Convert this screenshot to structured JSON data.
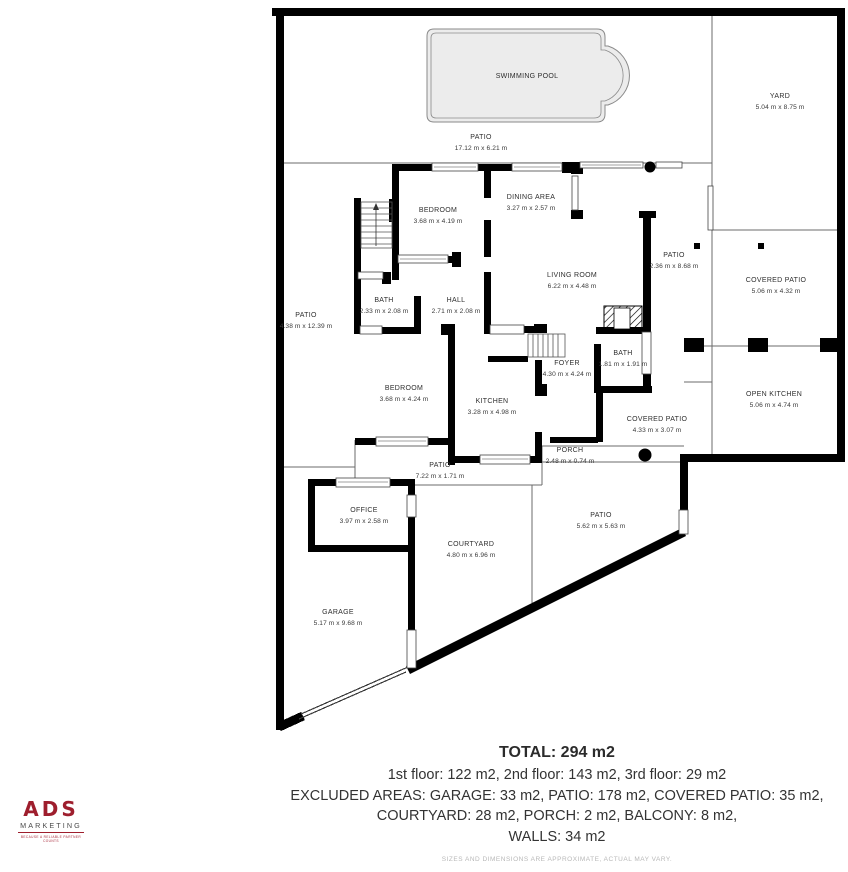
{
  "plan": {
    "rooms": [
      {
        "id": "swimming-pool",
        "name": "SWIMMING POOL",
        "dims": "",
        "x": 527,
        "y": 77
      },
      {
        "id": "yard",
        "name": "YARD",
        "dims": "5.04 m x 8.75 m",
        "x": 780,
        "y": 102
      },
      {
        "id": "patio-top",
        "name": "PATIO",
        "dims": "17.12 m x 6.21 m",
        "x": 481,
        "y": 143
      },
      {
        "id": "bedroom-1",
        "name": "BEDROOM",
        "dims": "3.68 m x 4.19 m",
        "x": 438,
        "y": 216
      },
      {
        "id": "dining-area",
        "name": "DINING AREA",
        "dims": "3.27 m x 2.57 m",
        "x": 531,
        "y": 203
      },
      {
        "id": "living-room",
        "name": "LIVING ROOM",
        "dims": "6.22 m x 4.48 m",
        "x": 572,
        "y": 281
      },
      {
        "id": "patio-right",
        "name": "PATIO",
        "dims": "2.36 m x 8.68 m",
        "x": 674,
        "y": 261
      },
      {
        "id": "covered-patio-right",
        "name": "COVERED PATIO",
        "dims": "5.06 m x 4.32 m",
        "x": 776,
        "y": 286
      },
      {
        "id": "bath-1",
        "name": "BATH",
        "dims": "2.33 m x 2.08 m",
        "x": 384,
        "y": 306
      },
      {
        "id": "hall",
        "name": "HALL",
        "dims": "2.71 m x 2.08 m",
        "x": 456,
        "y": 306
      },
      {
        "id": "patio-left",
        "name": "PATIO",
        "dims": "4.38 m x 12.39 m",
        "x": 306,
        "y": 321
      },
      {
        "id": "foyer",
        "name": "FOYER",
        "dims": "4.30 m x 4.24 m",
        "x": 567,
        "y": 369
      },
      {
        "id": "bath-2",
        "name": "BATH",
        "dims": "1.81 m x 1.91 m",
        "x": 623,
        "y": 359
      },
      {
        "id": "bedroom-2",
        "name": "BEDROOM",
        "dims": "3.68 m x 4.24 m",
        "x": 404,
        "y": 394
      },
      {
        "id": "kitchen",
        "name": "KITCHEN",
        "dims": "3.28 m x 4.98 m",
        "x": 492,
        "y": 407
      },
      {
        "id": "open-kitchen",
        "name": "OPEN KITCHEN",
        "dims": "5.06 m x 4.74 m",
        "x": 774,
        "y": 400
      },
      {
        "id": "covered-patio-center",
        "name": "COVERED PATIO",
        "dims": "4.33 m x 3.07 m",
        "x": 657,
        "y": 425
      },
      {
        "id": "porch",
        "name": "PORCH",
        "dims": "2.48 m x 0.74 m",
        "x": 570,
        "y": 456
      },
      {
        "id": "patio-center",
        "name": "PATIO",
        "dims": "7.22 m x 1.71 m",
        "x": 440,
        "y": 471
      },
      {
        "id": "office",
        "name": "OFFICE",
        "dims": "3.97 m x 2.58 m",
        "x": 364,
        "y": 516
      },
      {
        "id": "courtyard",
        "name": "COURTYARD",
        "dims": "4.80 m x 6.96 m",
        "x": 471,
        "y": 550
      },
      {
        "id": "patio-bottom",
        "name": "PATIO",
        "dims": "5.62 m x 5.63 m",
        "x": 601,
        "y": 521
      },
      {
        "id": "garage",
        "name": "GARAGE",
        "dims": "5.17 m x 9.68 m",
        "x": 338,
        "y": 618
      }
    ]
  },
  "footer": {
    "total": "TOTAL: 294 m2",
    "line1": "1st floor: 122 m2, 2nd floor: 143 m2, 3rd floor: 29 m2",
    "line2": "EXCLUDED AREAS: GARAGE: 33 m2, PATIO: 178 m2, COVERED PATIO: 35 m2,",
    "line3": "COURTYARD: 28 m2, PORCH: 2 m2, BALCONY: 8 m2,",
    "line4": "WALLS: 34 m2",
    "disclaimer": "SIZES AND DIMENSIONS ARE APPROXIMATE, ACTUAL MAY VARY."
  },
  "logo": {
    "brand": "ADS",
    "subtitle": "MARKETING",
    "tagline": "BECAUSE A RELIABLE PARTNER COUNTS"
  },
  "colors": {
    "wall": "#000000",
    "thin_line": "#6b6b6b",
    "pool_fill": "#ececec",
    "accent_red": "#9e1e2d",
    "text": "#333333",
    "muted": "#b8b8b8"
  }
}
